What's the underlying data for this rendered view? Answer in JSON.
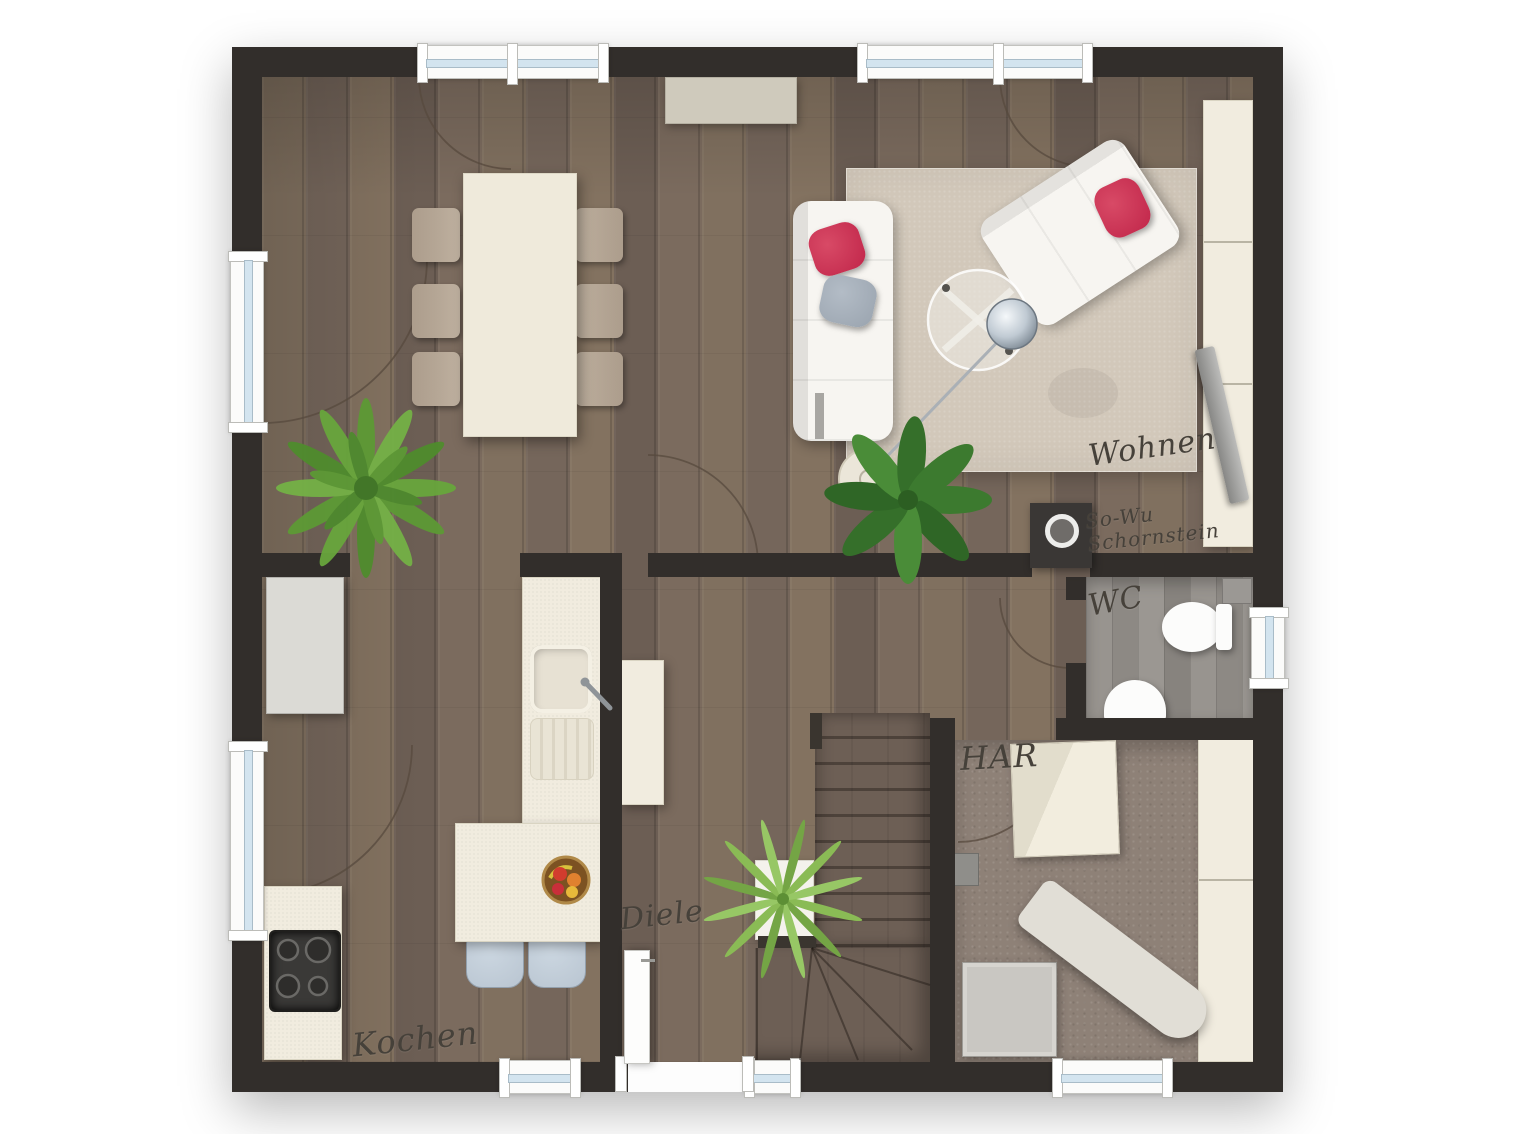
{
  "plan_type": "floor-plan",
  "rooms": {
    "wohnen": {
      "label": "Wohnen"
    },
    "kochen": {
      "label": "Kochen"
    },
    "diele": {
      "label": "Diele"
    },
    "wc": {
      "label": "WC"
    },
    "har": {
      "label": "HAR"
    }
  },
  "annotations": {
    "chimney": {
      "line1": "So-Wu",
      "line2": "Schornstein"
    }
  },
  "furniture": [
    "sofa",
    "loveseat",
    "coffee-table",
    "arc-lamp",
    "rug",
    "sideboard",
    "tv-board",
    "tv",
    "dining-table",
    "dining-chairs",
    "plant-fern",
    "plant-leaf",
    "plant-palm",
    "kitchen-counter",
    "sink",
    "fridge",
    "island",
    "bar-stools",
    "fruit-bowl",
    "stove",
    "wardrobe",
    "stairs",
    "toilet",
    "wc-sink",
    "cistern",
    "washer",
    "laundry-box",
    "ironing-board",
    "utility-cabinet",
    "entrance-door"
  ],
  "colors": {
    "wall": "#322e2b",
    "wood": "#7c6b5f",
    "stair_wood": "#6d5f55",
    "wc_floor": "#94908b",
    "carpet": "#8e8177",
    "rug": "#d2c8ba",
    "cream": "#f1ecdf",
    "white_furniture": "#f7f5f1",
    "pillow_red": "#c1264a",
    "pillow_gray": "#9aa4af",
    "stool": "#b9c5d1",
    "glass": "#d3e4ef",
    "ink": "#46413a",
    "plant": "#67a43c",
    "metal": "#a8b0b8"
  }
}
